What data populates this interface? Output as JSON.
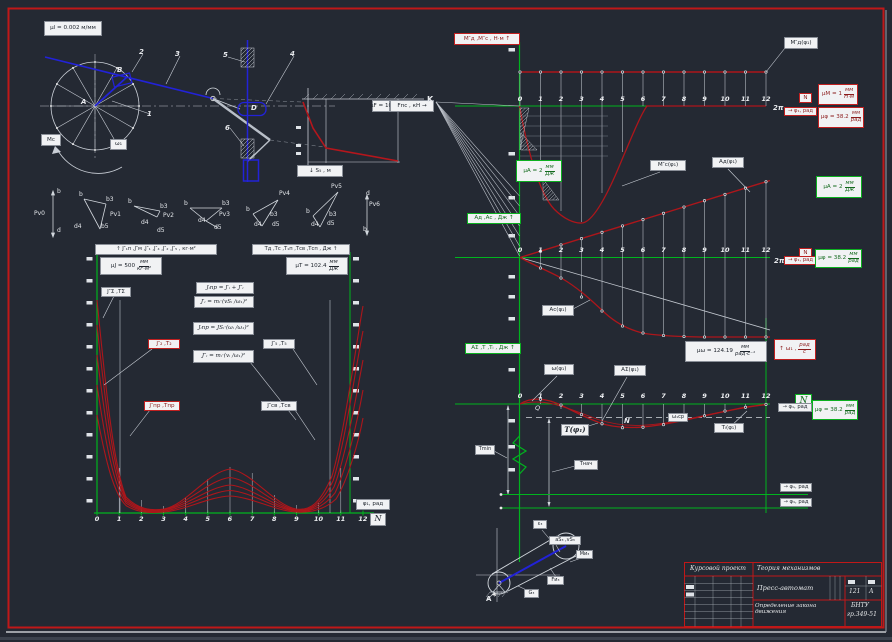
{
  "ticks": [
    "0",
    "1",
    "2",
    "3",
    "4",
    "5",
    "6",
    "7",
    "8",
    "9",
    "10",
    "11",
    "12"
  ],
  "mechanism": {
    "scale": "μl = 0.002 м/мм",
    "n1": "1",
    "n2": "2",
    "n3": "3",
    "n4": "4",
    "n5": "5",
    "n6": "6",
    "pa": "А",
    "pb": "B",
    "pd": "D",
    "mc": "Мс",
    "omega": "ω₁",
    "force_scale": "μF = 10",
    "force_axis": "Fпс , кН →",
    "s_axis": "↓ S₅ , м"
  },
  "polygons": {
    "pv0": {
      "name": "Pv0",
      "b": "b",
      "d": "d"
    },
    "pv1": {
      "name": "Pv1",
      "b": "b",
      "b3": "b3",
      "b5": "b5",
      "d4": "d4"
    },
    "pv2": {
      "name": "Pv2",
      "b": "b",
      "b3": "b3",
      "d4": "d4",
      "d5": "d5"
    },
    "pv3": {
      "name": "Pv3",
      "b": "b",
      "b3": "b3",
      "d4": "d4",
      "d5": "d5"
    },
    "pv4": {
      "name": "Pv4",
      "b": "b",
      "b3": "b3",
      "d4": "d4",
      "d5": "d5"
    },
    "pv5": {
      "name": "Pv5",
      "b": "b",
      "b3": "b3",
      "d4": "d4",
      "d5": "d5"
    },
    "pv6": {
      "name": "Pv6",
      "b": "b",
      "d": "d"
    }
  },
  "left_chart": {
    "y_left_title": "↑ J″₁п ,J″м ,J″₁ ,J″₄ ,J″₂ ,J″₅ , кг·м²",
    "mu_j": {
      "pre": "μJ = 500",
      "num": "мм",
      "den": "кг·м²"
    },
    "y_right_title": "Tд ,Tс ,T₁п ,Tсв ,Tсп , Дж ↑",
    "mu_t": {
      "pre": "μT = 102.4",
      "num": "мм",
      "den": "Дж"
    },
    "f1": "Jᵢпр = J′ᵢ + J″ᵢ",
    "f2": "J′ᵢ = mᵢ·(vSᵢ /ω₁)²",
    "f3": "Jᵢпр = JSᵢ·(ωᵢ /ω₁)²",
    "f4": "J″ᵢ = mᵢ·(vᵢ /ω₁)²",
    "lbl_j2": "J″₂ ,T₂",
    "lbl_jpr": "J″пр ,Tпр",
    "lbl_j5": "J″₅ ,T₅",
    "lbl_jsv": "J″св ,Tсв",
    "lbl_jsum": "J″Σ ,TΣ",
    "x_label": "φ₁, рад",
    "n": "N"
  },
  "m_chart": {
    "y_title": "М″д ,М″с , Н·м ↑",
    "md": "М″д(φ₁)",
    "mc": "М″с(φ₁)",
    "mu_m": {
      "pre": "μM = 1",
      "num": "мм",
      "den": "Н·м"
    },
    "mu_phi": {
      "pre": "μφ = 38.2",
      "num": "мм",
      "den": "рад"
    },
    "two_pi": "2π",
    "x_label": "→ φ₁, рад",
    "n": "N",
    "k": "K"
  },
  "a_chart": {
    "y_title": "Aд ,Aс , Дж ↑",
    "mu_a_left": {
      "pre": "μA = 2",
      "num": "мм",
      "den": "Дж"
    },
    "mu_a_right": {
      "pre": "μA = 2",
      "num": "мм",
      "den": "Дж"
    },
    "mu_phi": {
      "pre": "μφ = 38.2",
      "num": "мм",
      "den": "рад"
    },
    "ad": "Aд(φ₁)",
    "ac": "Aс(φ₁)",
    "two_pi": "2π",
    "x_label": "→ φ₁, рад",
    "n": "N",
    "y_title2": "AΣ ,T ,Tᵢ , Дж ↑",
    "mu_omega": {
      "pre": "μω = 124.19",
      "num": "мм",
      "den": "рад·с⁻¹"
    },
    "omega_axis": {
      "pre": "↑ ω₁ ,",
      "num": "рад",
      "den": "с"
    }
  },
  "w_chart": {
    "omega": "ω(φ₁)",
    "asum": "AΣ(φ₁)",
    "t": "T(φ₁)",
    "ti": "Tᵢ(φ₁)",
    "omega_avg": "ω₁ср",
    "q": "Q",
    "n_mark": "N",
    "t_min": "Tmin",
    "t_nach": "Tнач",
    "mu_phi": {
      "pre": "μφ = 38.2",
      "num": "мм",
      "den": "рад"
    },
    "x_label": "→ φ₁, рад",
    "n": "N",
    "bottom1": "→ φ₁, рад",
    "bottom2": "→ φ₁, рад"
  },
  "small_mech": {
    "pa": "А",
    "t1": "ε₃",
    "t2": "aS₃ ,vS₃",
    "t3": "Mи₃",
    "t4": "Fи₃",
    "t5": "G₃"
  },
  "stamp": {
    "doc": "Курсовой проект",
    "discipline": "Теория механизмов",
    "title": "Пресс-автомат",
    "sheet": "121",
    "format": "А",
    "subtitle": "Определение закона движения",
    "org": "БНТУ",
    "group": "гр.349-51"
  },
  "chart_data": [
    {
      "id": "moments",
      "type": "line",
      "title": "Приведённые моменты М″д, М″с",
      "xlabel": "φ₁ (позиции 0–12, 0…2π рад)",
      "ylabel": "Н·м (μM = 1 мм/Н·м, оценка)",
      "x": [
        0,
        1,
        2,
        3,
        4,
        5,
        6,
        7,
        8,
        9,
        10,
        11,
        12
      ],
      "series": [
        {
          "name": "М″д(φ₁)",
          "values": [
            34,
            34,
            34,
            34,
            34,
            34,
            34,
            34,
            34,
            34,
            34,
            34,
            34
          ]
        },
        {
          "name": "М″с(φ₁)",
          "values": [
            0,
            -54,
            -104,
            -117,
            -89,
            -40,
            0,
            0,
            0,
            0,
            0,
            0,
            0
          ]
        }
      ]
    },
    {
      "id": "works",
      "type": "line",
      "title": "Работы Aд, Aс",
      "xlabel": "φ₁ (позиции 0–12)",
      "ylabel": "Дж (μA = 2 мм/Дж, оценка)",
      "x": [
        0,
        1,
        2,
        3,
        4,
        5,
        6,
        7,
        8,
        9,
        10,
        11,
        12
      ],
      "series": [
        {
          "name": "Aд(φ₁)",
          "values": [
            0,
            3.2,
            6.4,
            9.7,
            12.9,
            16.1,
            19.3,
            22.6,
            25.8,
            29.0,
            32.2,
            35.5,
            38.7
          ]
        },
        {
          "name": "Aс(φ₁)",
          "values": [
            0,
            -5.2,
            -10.2,
            -19.8,
            -27.2,
            -34.2,
            -37.8,
            -39.0,
            -39.5,
            -39.8,
            -39.8,
            -39.8,
            -39.8
          ]
        }
      ]
    },
    {
      "id": "omega_T",
      "type": "line",
      "title": "ω₁(φ₁) и T(φ₁), Tᵢ(φ₁)",
      "note": "отклонение от средней линии, мм чертежа (оценка); μω = 124.19 мм/(рад·с⁻¹), μφ = 38.2 мм/рад",
      "x": [
        0,
        1,
        2,
        3,
        4,
        5,
        6,
        7,
        8,
        9,
        10,
        11,
        12
      ],
      "series": [
        {
          "name": "ω₁(φ₁)",
          "values": [
            0,
            4.7,
            -1,
            -10.5,
            -19.8,
            -23.7,
            -23.2,
            -20.6,
            -16.4,
            -11.8,
            -7,
            -3.3,
            -0.4
          ]
        },
        {
          "name": "T(φ₁)",
          "values": [
            0,
            2.5,
            0.5,
            -15.5,
            -20,
            -21.8,
            -21.4,
            -20.6,
            -16.8,
            -12.4,
            -7.6,
            -3.4,
            -0.8
          ]
        }
      ]
    },
    {
      "id": "inertia",
      "type": "line",
      "title": "J″пр(φ₁) и T(φ₁) — семейство кривых",
      "note": "мм чертежа над осью (оценка); μJ = 500 мм/(кг·м²), μT = 102.4 мм/Дж",
      "x": [
        0,
        1,
        2,
        3,
        4,
        5,
        6,
        7,
        8,
        9,
        10,
        11,
        12
      ],
      "series": [
        {
          "name": "J″₂,T₂",
          "values": [
            213,
            33,
            5,
            6,
            34,
            44,
            46,
            44,
            34,
            6,
            5,
            43,
            208
          ]
        },
        {
          "name": "J″₃,T₃",
          "values": [
            188,
            25,
            4,
            5,
            26,
            34,
            36,
            34,
            26,
            5,
            4,
            33,
            183
          ]
        },
        {
          "name": "J″₄,T₄",
          "values": [
            158,
            18,
            3,
            4,
            18,
            25,
            27,
            25,
            18,
            4,
            3,
            24,
            155
          ]
        },
        {
          "name": "J″₅,T₅",
          "values": [
            128,
            12,
            2,
            3,
            12,
            17,
            19,
            17,
            12,
            3,
            2,
            16,
            126
          ]
        },
        {
          "name": "J″св,Tсв",
          "values": [
            98,
            7,
            1,
            2,
            7,
            10,
            11,
            10,
            7,
            2,
            1,
            10,
            96
          ]
        }
      ]
    },
    {
      "id": "force",
      "type": "line",
      "title": "Fпс(S₅) — профиль силы полезного сопротивления",
      "note": "качественная форма (оценка)",
      "x_rel": [
        0,
        0.1,
        0.25,
        1
      ],
      "values_rel": [
        1,
        0.55,
        0.2,
        0.02
      ]
    }
  ]
}
